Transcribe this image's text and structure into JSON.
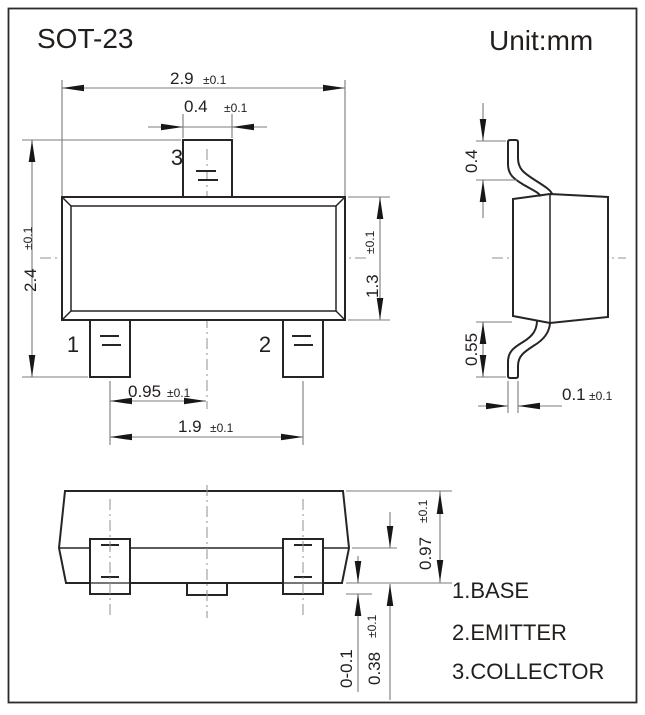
{
  "title": "SOT-23",
  "unit_label": "Unit:mm",
  "package": {
    "top_view": {
      "dim_overall_width": {
        "value": "2.9",
        "tol": "±0.1"
      },
      "dim_pin3_width": {
        "value": "0.4",
        "tol": "±0.1"
      },
      "dim_overall_depth": {
        "value": "2.4",
        "tol": "±0.1"
      },
      "dim_body_depth": {
        "value": "1.3",
        "tol": "±0.1"
      },
      "dim_pin_offset": {
        "value": "0.95",
        "tol": "±0.1"
      },
      "dim_pin_span": {
        "value": "1.9",
        "tol": "±0.1"
      },
      "pin1_label": "1",
      "pin2_label": "2",
      "pin3_label": "3"
    },
    "side_view": {
      "dim_lead_top_length": {
        "value": "0.4"
      },
      "dim_lead_bottom_length": {
        "value": "0.55"
      },
      "dim_lead_thickness": {
        "value": "0.1",
        "tol": "±0.1"
      }
    },
    "front_view": {
      "dim_body_height": {
        "value": "0.97",
        "tol": "±0.1"
      },
      "dim_lead_shoulder": {
        "value": "0.38",
        "tol": "±0.1"
      },
      "dim_standoff": {
        "value": "0-0.1"
      }
    }
  },
  "legend": {
    "items": [
      "1.BASE",
      "2.EMITTER",
      "3.COLLECTOR"
    ]
  }
}
